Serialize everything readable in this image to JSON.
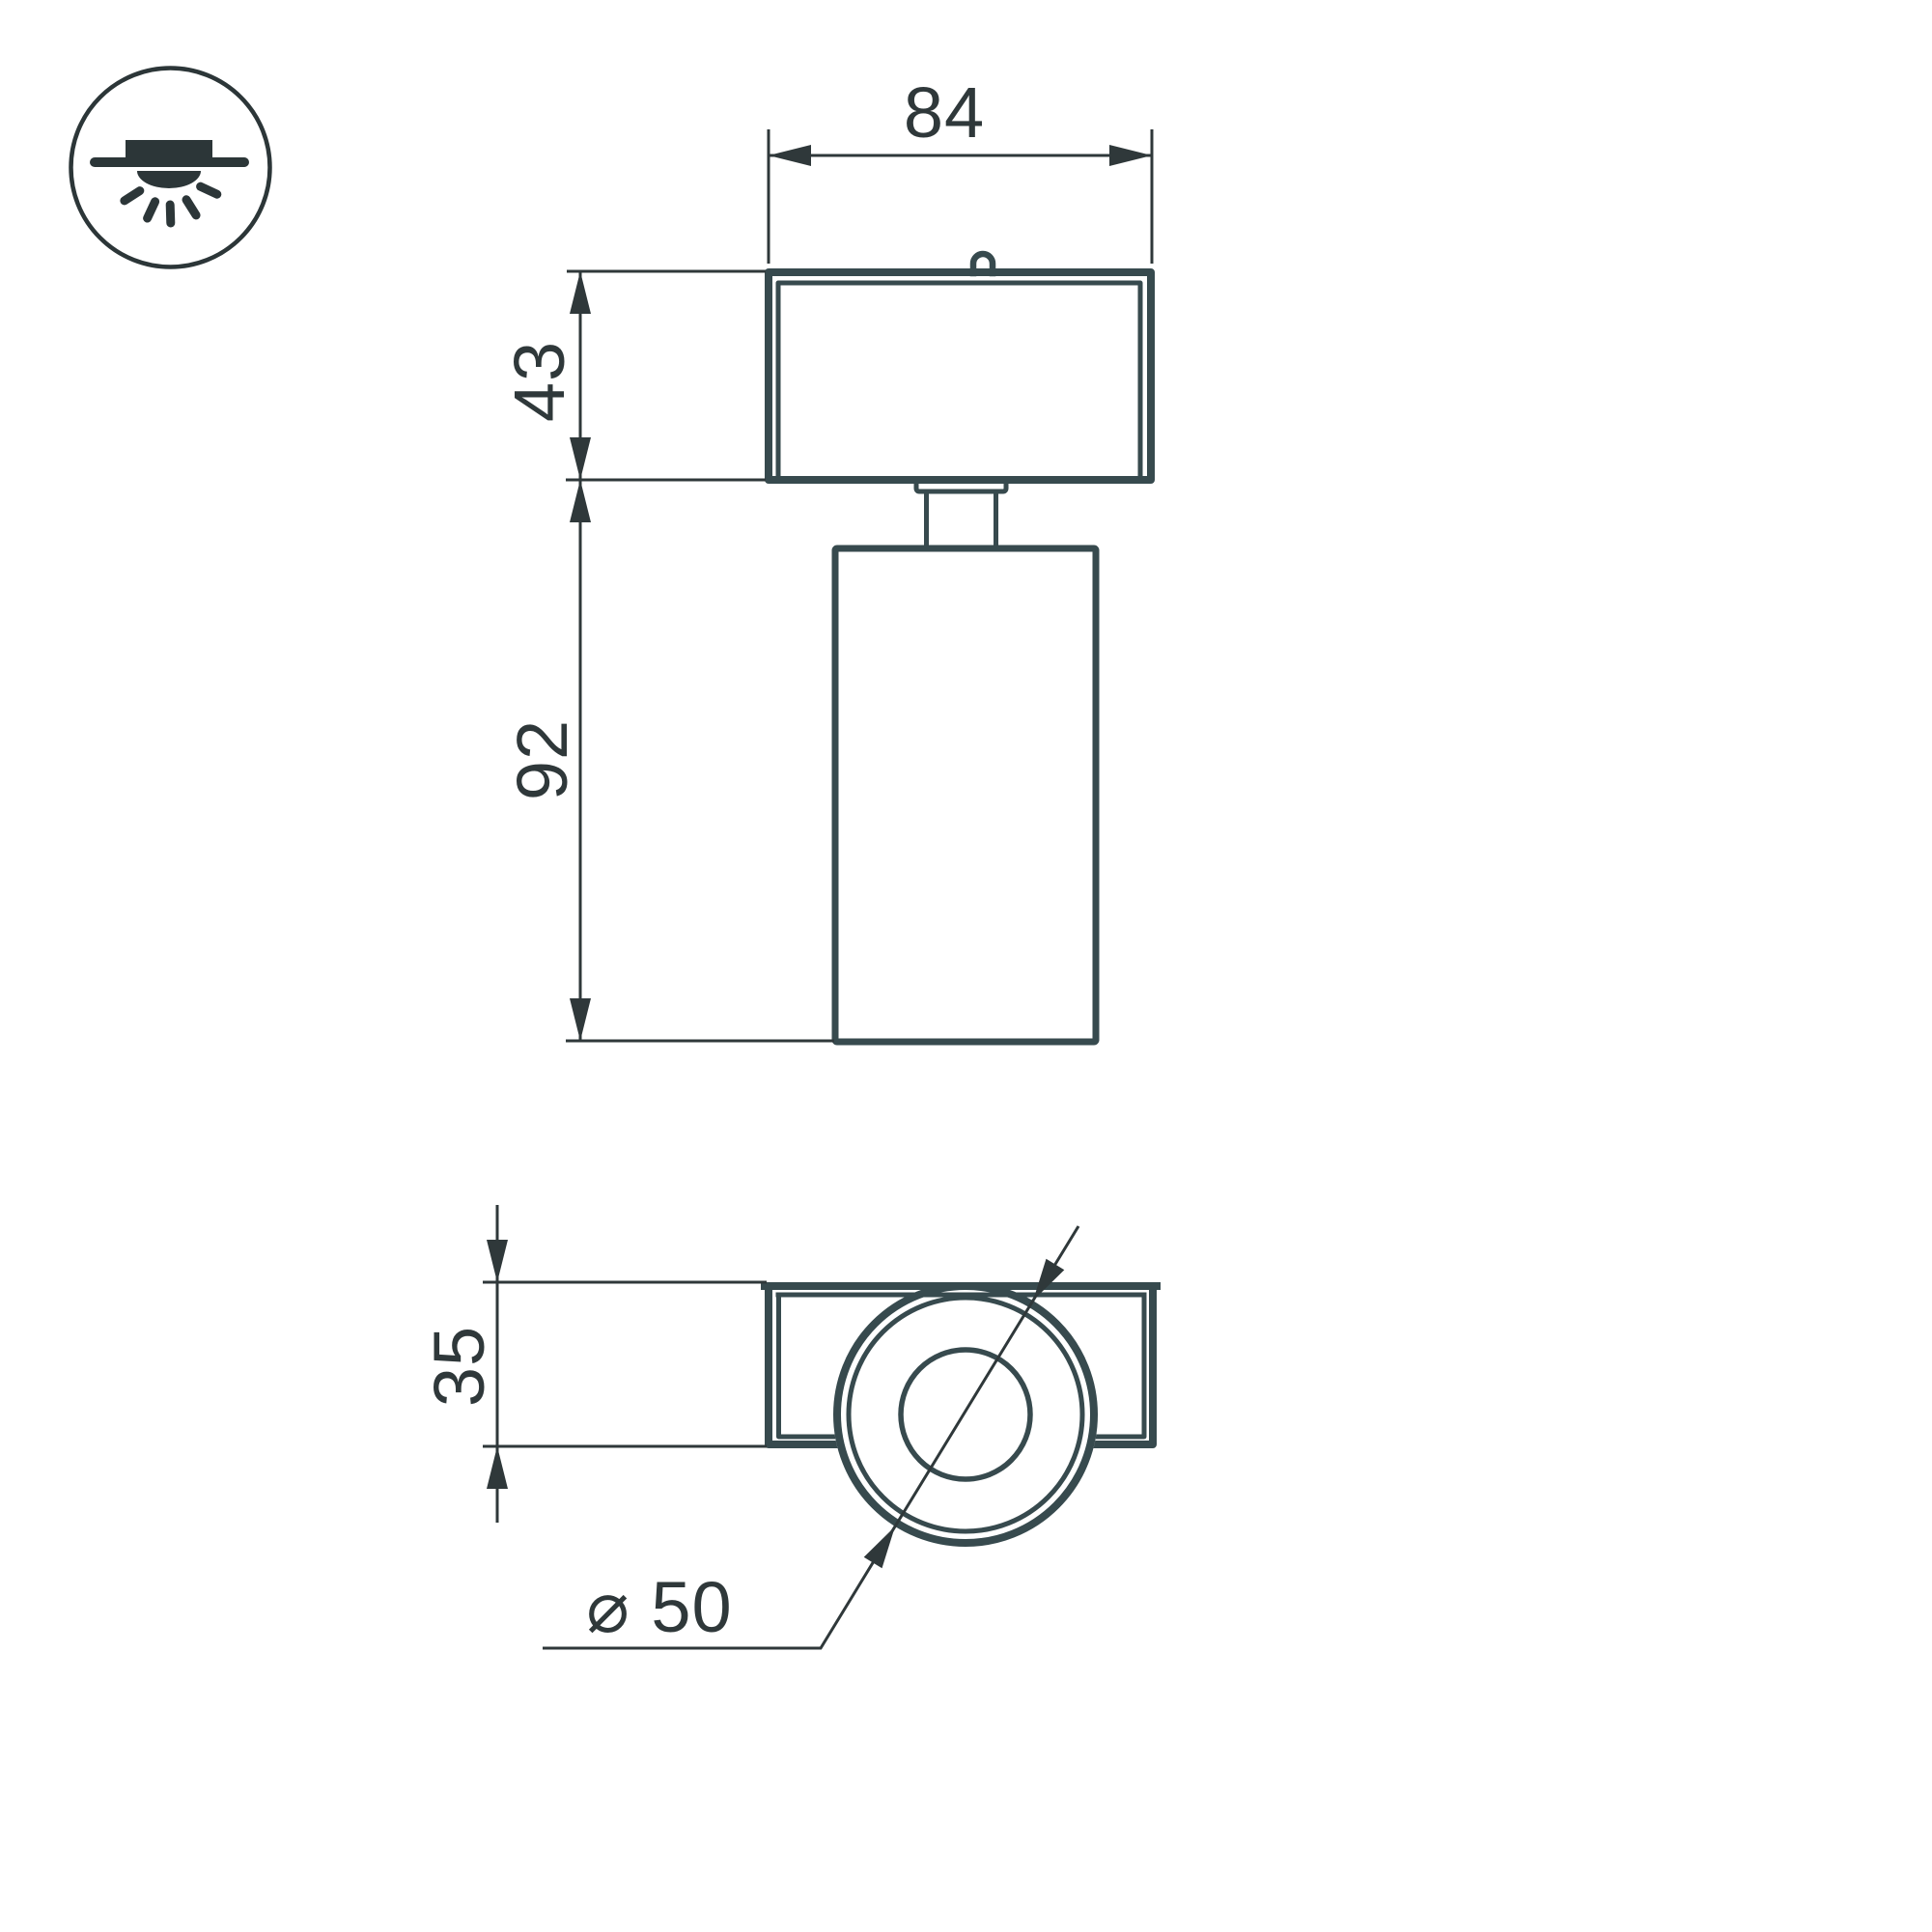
{
  "drawing": {
    "title": "spot-light-dimension-drawing",
    "icon": "surface-mounted-ceiling-light-icon",
    "front_view": {
      "dim_width": "84",
      "dim_housing_height": "43",
      "dim_body_height": "92"
    },
    "bottom_view": {
      "dim_depth": "35",
      "dim_diameter": "⌀ 50"
    }
  },
  "colors": {
    "background": "#ffffff",
    "outline": "#374a4e",
    "dimension": "#2f383a",
    "icon": "#2c3638"
  }
}
